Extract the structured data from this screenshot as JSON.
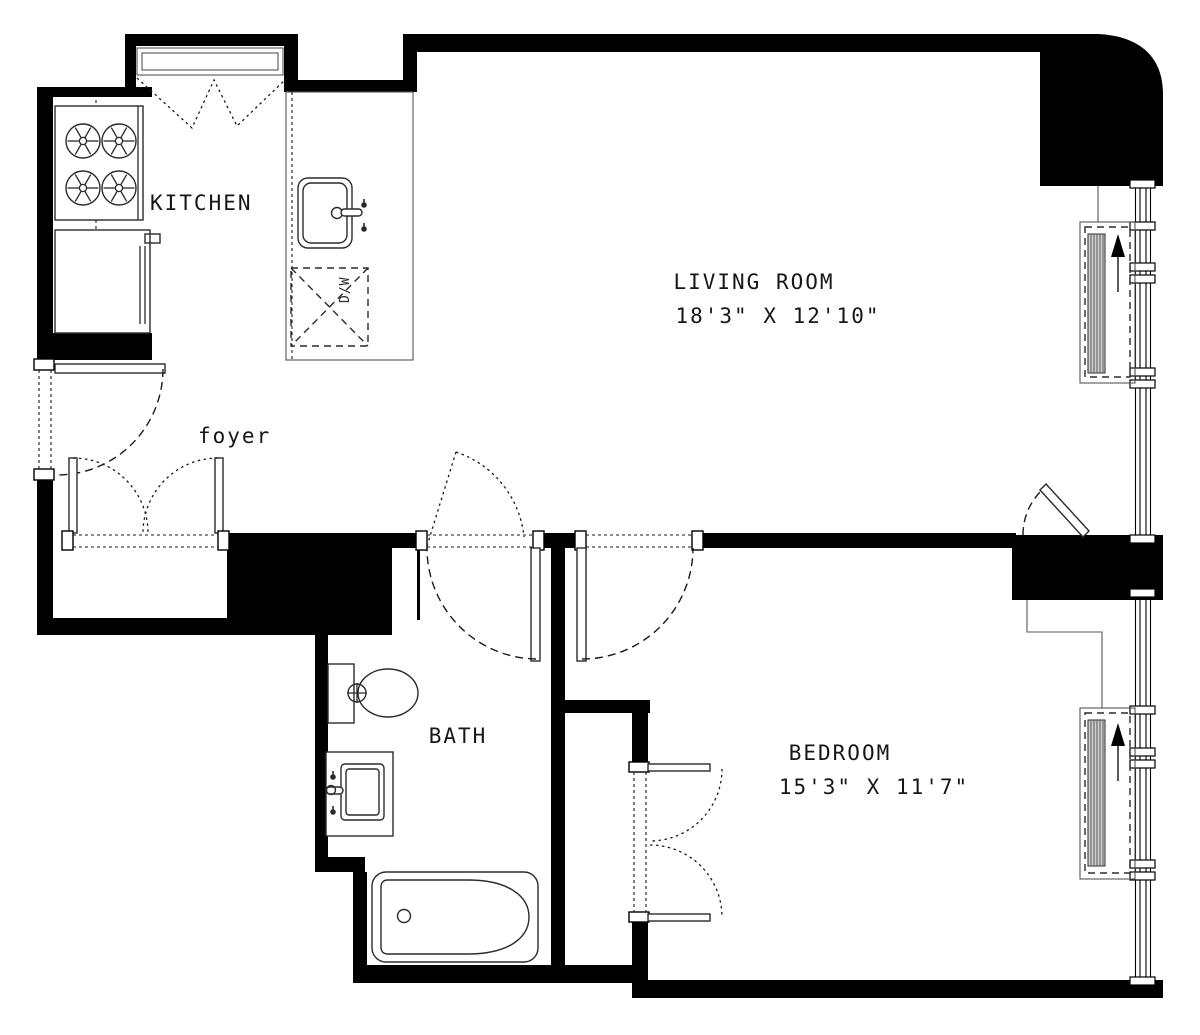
{
  "labels": {
    "kitchen": "KITCHEN",
    "living_room": "LIVING ROOM",
    "living_room_dims": "18'3\" X 12'10\"",
    "foyer": "foyer",
    "bath": "BATH",
    "bedroom": "BEDROOM",
    "bedroom_dims": "15'3\" X 11'7\"",
    "dishwasher": "D/W"
  },
  "rooms": [
    {
      "name": "Kitchen",
      "dims": ""
    },
    {
      "name": "Living Room",
      "dims": "18'3\" X 12'10\""
    },
    {
      "name": "Foyer",
      "dims": ""
    },
    {
      "name": "Bath",
      "dims": ""
    },
    {
      "name": "Bedroom",
      "dims": "15'3\" X 11'7\""
    }
  ],
  "colors": {
    "wall": "#000000",
    "line": "#2b2b2b",
    "background": "#ffffff"
  }
}
